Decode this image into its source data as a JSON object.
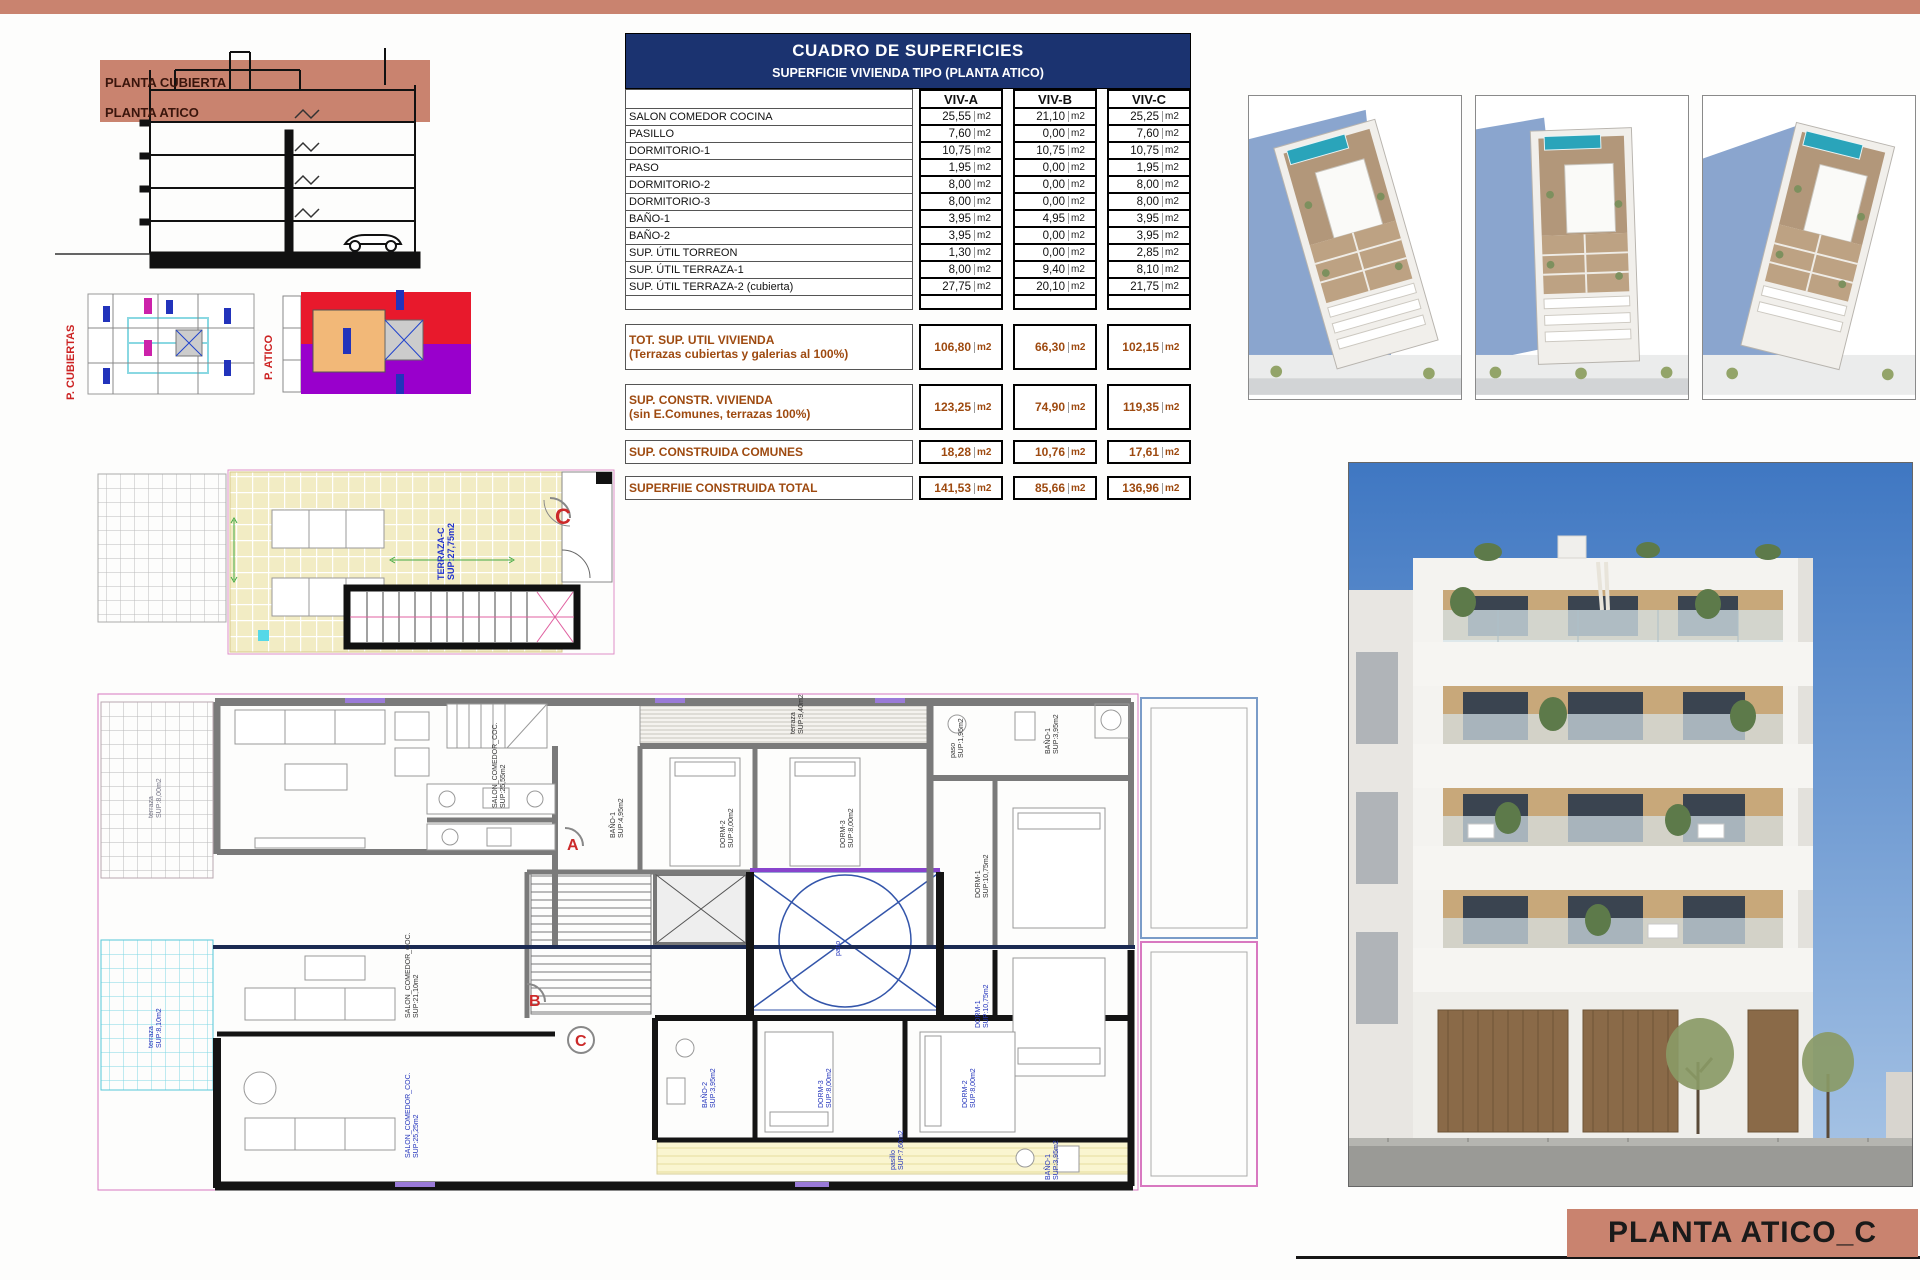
{
  "sheet": {
    "title_box": "PLANTA ATICO_C",
    "colors": {
      "accent_salmon": "#c9836f",
      "header_navy": "#1b3370",
      "summary_brown": "#9e4a10",
      "label_blue": "#2233bb",
      "marker_red": "#cc2a2a",
      "pool_teal": "#2aa4ba",
      "wall_gray": "#7a7a7a",
      "wall_black": "#141414",
      "boundary_pink": "#d878c0",
      "terrace_yellow": "#f2ecc4",
      "terrace_cyan": "#7fd8e4"
    }
  },
  "section_view": {
    "labels": {
      "cubierta": "PLANTA CUBIERTA",
      "atico": "PLANTA ATICO"
    }
  },
  "key_plans": {
    "cubiertas_label": "P. CUBIERTAS",
    "atico_label": "P. ATICO"
  },
  "surface_table": {
    "title": "CUADRO DE SUPERFICIES",
    "subtitle": "SUPERFICIE VIVIENDA TIPO  (PLANTA ATICO)",
    "columns": [
      "VIV-A",
      "VIV-B",
      "VIV-C"
    ],
    "unit": "m2",
    "rows": [
      {
        "label": "SALON COMEDOR COCINA",
        "values": [
          "25,55",
          "21,10",
          "25,25"
        ]
      },
      {
        "label": "PASILLO",
        "values": [
          "7,60",
          "0,00",
          "7,60"
        ]
      },
      {
        "label": "DORMITORIO-1",
        "values": [
          "10,75",
          "10,75",
          "10,75"
        ]
      },
      {
        "label": "PASO",
        "values": [
          "1,95",
          "0,00",
          "1,95"
        ]
      },
      {
        "label": "DORMITORIO-2",
        "values": [
          "8,00",
          "0,00",
          "8,00"
        ]
      },
      {
        "label": "DORMITORIO-3",
        "values": [
          "8,00",
          "0,00",
          "8,00"
        ]
      },
      {
        "label": "BAÑO-1",
        "values": [
          "3,95",
          "4,95",
          "3,95"
        ]
      },
      {
        "label": "BAÑO-2",
        "values": [
          "3,95",
          "0,00",
          "3,95"
        ]
      },
      {
        "label": "SUP. ÚTIL TORREON",
        "values": [
          "1,30",
          "0,00",
          "2,85"
        ]
      },
      {
        "label": "SUP. ÚTIL TERRAZA-1",
        "values": [
          "8,00",
          "9,40",
          "8,10"
        ]
      },
      {
        "label": "SUP. ÚTIL TERRAZA-2 (cubierta)",
        "values": [
          "27,75",
          "20,10",
          "21,75"
        ]
      }
    ],
    "summary_rows": [
      {
        "label": "TOT. SUP. UTIL VIVIENDA",
        "sublabel": "(Terrazas cubiertas y galerias al 100%)",
        "values": [
          "106,80",
          "66,30",
          "102,15"
        ]
      },
      {
        "label": "SUP. CONSTR. VIVIENDA",
        "sublabel": "(sin E.Comunes, terrazas 100%)",
        "values": [
          "123,25",
          "74,90",
          "119,35"
        ]
      },
      {
        "label": "SUP. CONSTRUIDA COMUNES",
        "sublabel": "",
        "values": [
          "18,28",
          "10,76",
          "17,61"
        ]
      },
      {
        "label": "SUPERFIIE CONSTRUIDA TOTAL",
        "sublabel": "",
        "values": [
          "141,53",
          "85,66",
          "136,96"
        ]
      }
    ]
  },
  "roof_plan": {
    "marker": "C",
    "labels": {
      "terraza_name": "TERRAZA-C",
      "terraza_area": "SUP:27,75m2"
    }
  },
  "floor_plan": {
    "markers": {
      "a": "A",
      "b": "B",
      "c": "C"
    },
    "labels": {
      "terraza_nw_name": "terraza",
      "terraza_nw_area": "SUP:8,00m2",
      "terraza_w_name": "terraza",
      "terraza_w_area": "SUP:8,10m2",
      "salon_a_name": "SALON_COMEDOR_COC.",
      "salon_a_area": "SUP:25,55m2",
      "salon_b_name": "SALON_COMEDOR_COC.",
      "salon_b_area": "SUP:21,10m2",
      "salon_c_name": "SALON_COMEDOR_COC.",
      "salon_c_area": "SUP:25,25m2",
      "deck_name": "terraza",
      "deck_area": "SUP:9,40m2",
      "bano1_b_name": "BAÑO-1",
      "bano1_b_area": "SUP:4,95m2",
      "bano2_name": "BAÑO-2",
      "bano2_area": "SUP:3,95m2",
      "dorm2_name": "DORM-2",
      "dorm2_area": "SUP:8,00m2",
      "dorm3_name": "DORM-3",
      "dorm3_area": "SUP:8,00m2",
      "paso_name": "paso",
      "paso_area": "SUP:1,95m2",
      "bano1_name": "BAÑO-1",
      "bano1_area": "SUP:3,95m2",
      "dorm1_name": "DORM-1",
      "dorm1_area": "SUP:10,75m2",
      "patio_name": "patio",
      "pasillo_name": "pasillo",
      "pasillo_area": "SUP:7,60m2"
    }
  }
}
